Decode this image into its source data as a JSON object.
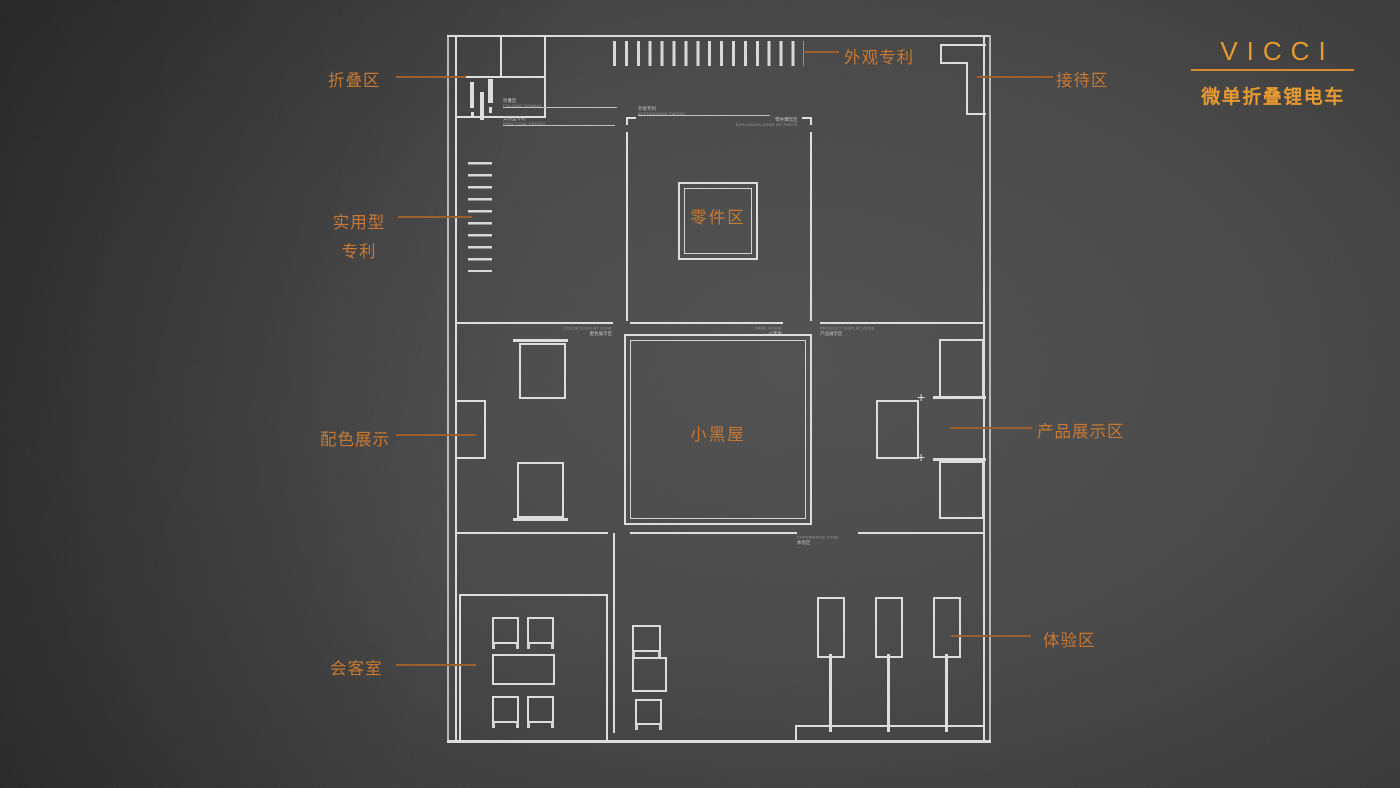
{
  "brand": {
    "logo": "VICCI",
    "product": "微单折叠锂电车"
  },
  "callouts": {
    "folding": "折叠区",
    "appearance_patent": "外观专利",
    "reception": "接待区",
    "utility_patent_l1": "实用型",
    "utility_patent_l2": "专利",
    "parts": "零件区",
    "color_display": "配色展示",
    "dark_room": "小黑屋",
    "product_display": "产品展示区",
    "meeting_room": "会客室",
    "experience": "体验区"
  },
  "plan_annotations": {
    "folding": {
      "cn": "折叠区",
      "en": "FOLDING DOMAIN"
    },
    "utility": {
      "cn": "实用型专利",
      "en": "PRACTICAL PATENT"
    },
    "appearance": {
      "cn": "外观专利",
      "en": "APPEARANCE PATENT"
    },
    "parts_explosion": {
      "cn": "零件爆炸区",
      "en": "EXPLOSION ZONE OF PARTS"
    },
    "color": {
      "cn": "配色展示区",
      "en": "COLOR DISPLAY ZONE"
    },
    "dark": {
      "cn": "小黑屋",
      "en": "DARK ROOM"
    },
    "product": {
      "cn": "产品展示区",
      "en": "PRODUCT DISPLAY ZONE"
    },
    "experience": {
      "cn": "体验区",
      "en": "EXPERIENCE ZONE"
    }
  },
  "icons": {
    "plus_marker": "+"
  },
  "colors": {
    "accent": "#c8772f",
    "logo_orange": "#e9992e",
    "leader_line": "#9c5d28",
    "wall_line": "#dedede",
    "background": "#454545"
  }
}
